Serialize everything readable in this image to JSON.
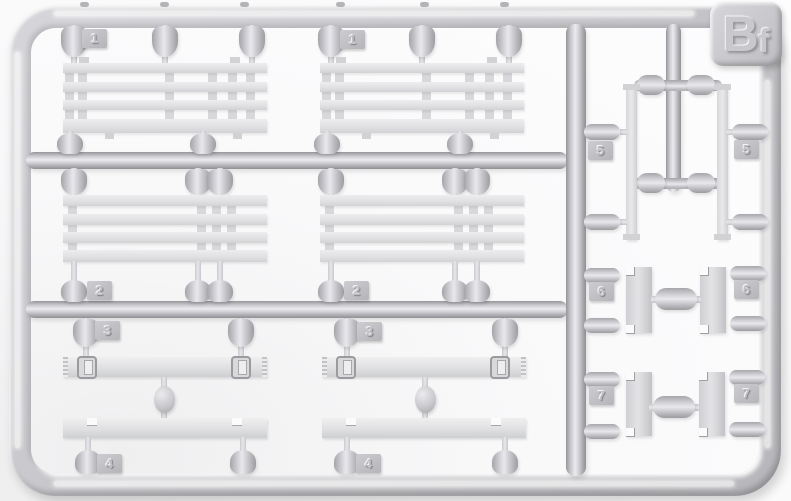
{
  "photo": {
    "subject": "Light gray injection-molded plastic model sprue (runner frame) with numbered attachment parts, photographed on a white background",
    "sprue_id": {
      "label": "Bf",
      "main": "B",
      "sub": "f"
    },
    "colors": {
      "background": "#fbfbfc",
      "plastic": "#c8c8cc",
      "plastic_highlight": "#ebebef",
      "plastic_shadow": "#97979b",
      "part_surface": "#e2e2e4"
    },
    "tags": {
      "t1a": "1",
      "t1b": "1",
      "t2a": "2",
      "t2b": "2",
      "t3a": "3",
      "t3b": "3",
      "t4a": "4",
      "t4b": "4",
      "t5a": "5",
      "t5b": "5",
      "t6a": "6",
      "t6b": "6",
      "t7a": "7",
      "t7b": "7"
    }
  }
}
